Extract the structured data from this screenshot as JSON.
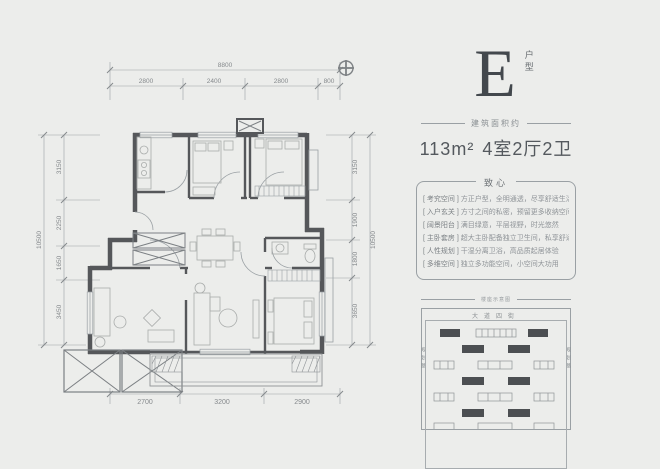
{
  "floorplan": {
    "dim_top_total": "8800",
    "dim_top": [
      "2800",
      "2400",
      "2800",
      "800"
    ],
    "dim_left_total": "10500",
    "dim_left": [
      "3150",
      "2250",
      "1650",
      "3450"
    ],
    "dim_right_total": "10500",
    "dim_right": [
      "3150",
      "1900",
      "1800",
      "3650"
    ],
    "dim_bottom": [
      "2700",
      "3200",
      "2900"
    ]
  },
  "info": {
    "type_letter": "E",
    "type_label": "户型",
    "area_caption": "建筑面积约",
    "area_value": "113m²",
    "layout_value": "4室2厅2卫",
    "card_title": "致心",
    "features": [
      {
        "label": "[ 考究空间 ]",
        "text": "方正户型，全明通透，尽享舒适生活"
      },
      {
        "label": "[ 入户玄关 ]",
        "text": "方寸之间的私密，预留更多收纳空间"
      },
      {
        "label": "[ 阔景阳台 ]",
        "text": "满目绿意，平层视野，时光悠然"
      },
      {
        "label": "[ 主卧套房 ]",
        "text": "超大主卧配备独立卫生间，私享舒适"
      },
      {
        "label": "[ 人性规划 ]",
        "text": "干湿分离卫浴，高品质起居体验"
      },
      {
        "label": "[ 多维空间 ]",
        "text": "独立多功能空间，小空间大功用"
      }
    ]
  },
  "siteplan": {
    "caption": "楼座示意图",
    "street_top": "大道四街",
    "street_left": "规划路",
    "street_right": "规划路"
  },
  "colors": {
    "background": "#ecedeb",
    "wall": "#55575a",
    "dimension": "#9aa0a4",
    "accent_dark": "#43484d"
  }
}
